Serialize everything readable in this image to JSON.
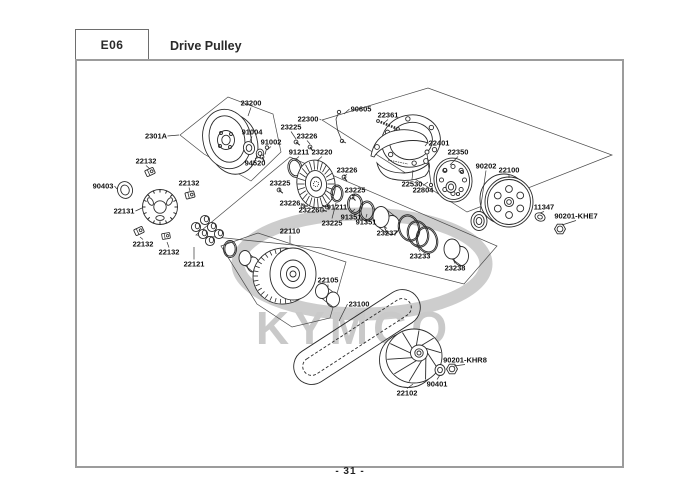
{
  "header": {
    "code": "E06",
    "title": "Drive Pulley"
  },
  "footer": {
    "page_number": "- 31 -"
  },
  "watermark": {
    "brand": "KYMCO"
  },
  "colors": {
    "line": "#2b2b2b",
    "frame_border": "#9c9c9c",
    "watermark_gray": "#cdcdcd"
  },
  "diagram": {
    "labels": [
      {
        "text": "23200",
        "x": 251,
        "y": 103,
        "tx": 248,
        "ty": 116
      },
      {
        "text": "2301A",
        "x": 156,
        "y": 136,
        "tx": 179,
        "ty": 135
      },
      {
        "text": "91004",
        "x": 252,
        "y": 132,
        "tx": 250,
        "ty": 141
      },
      {
        "text": "91002",
        "x": 271,
        "y": 142,
        "tx": 267,
        "ty": 150
      },
      {
        "text": "94520",
        "x": 255,
        "y": 163,
        "tx": 261,
        "ty": 157
      },
      {
        "text": "22132",
        "x": 146,
        "y": 161,
        "tx": 150,
        "ty": 169
      },
      {
        "text": "90403",
        "x": 103,
        "y": 186,
        "tx": 117,
        "ty": 189
      },
      {
        "text": "22131",
        "x": 124,
        "y": 211,
        "tx": 142,
        "ty": 208
      },
      {
        "text": "22132",
        "x": 189,
        "y": 183,
        "tx": 190,
        "ty": 191
      },
      {
        "text": "22132",
        "x": 143,
        "y": 244,
        "tx": 140,
        "ty": 237
      },
      {
        "text": "22132",
        "x": 169,
        "y": 252,
        "tx": 167,
        "ty": 242
      },
      {
        "text": "22121",
        "x": 194,
        "y": 264,
        "tx": 194,
        "ty": 247
      },
      {
        "text": "22300",
        "x": 308,
        "y": 119,
        "tx": 321,
        "ty": 120
      },
      {
        "text": "90605",
        "x": 361,
        "y": 109,
        "tx": 344,
        "ty": 114
      },
      {
        "text": "22361",
        "x": 388,
        "y": 115,
        "tx": 384,
        "ty": 123
      },
      {
        "text": "23225",
        "x": 291,
        "y": 127,
        "tx": 296,
        "ty": 139
      },
      {
        "text": "23226",
        "x": 307,
        "y": 136,
        "tx": 310,
        "ty": 144
      },
      {
        "text": "91211",
        "x": 299,
        "y": 152,
        "tx": 296,
        "ty": 159
      },
      {
        "text": "23220",
        "x": 322,
        "y": 152,
        "tx": 317,
        "ty": 161
      },
      {
        "text": "23226",
        "x": 347,
        "y": 170,
        "tx": 344,
        "ty": 176
      },
      {
        "text": "23225",
        "x": 355,
        "y": 190,
        "tx": 352,
        "ty": 196
      },
      {
        "text": "23225",
        "x": 280,
        "y": 183,
        "tx": 279,
        "ty": 190
      },
      {
        "text": "23226",
        "x": 290,
        "y": 203,
        "tx": 303,
        "ty": 206
      },
      {
        "text": "23226",
        "x": 309,
        "y": 210,
        "tx": 323,
        "ty": 210
      },
      {
        "text": "91211",
        "x": 337,
        "y": 207,
        "tx": 326,
        "ty": 207
      },
      {
        "text": "23225",
        "x": 332,
        "y": 223,
        "tx": 336,
        "ty": 203
      },
      {
        "text": "91351",
        "x": 351,
        "y": 217,
        "tx": 355,
        "ty": 209
      },
      {
        "text": "91351",
        "x": 366,
        "y": 222,
        "tx": 367,
        "ty": 214
      },
      {
        "text": "23237",
        "x": 387,
        "y": 233,
        "tx": 384,
        "ty": 226
      },
      {
        "text": "23233",
        "x": 420,
        "y": 256,
        "tx": 416,
        "ty": 244
      },
      {
        "text": "23238",
        "x": 455,
        "y": 268,
        "tx": 453,
        "ty": 259
      },
      {
        "text": "22401",
        "x": 439,
        "y": 143,
        "tx": 425,
        "ty": 146
      },
      {
        "text": "22350",
        "x": 458,
        "y": 152,
        "tx": 450,
        "ty": 165
      },
      {
        "text": "22530",
        "x": 412,
        "y": 184,
        "tx": 413,
        "ty": 170
      },
      {
        "text": "22804",
        "x": 423,
        "y": 190,
        "tx": 428,
        "ty": 182
      },
      {
        "text": "90202",
        "x": 486,
        "y": 166,
        "tx": 480,
        "ty": 212
      },
      {
        "text": "22100",
        "x": 509,
        "y": 170,
        "tx": 509,
        "ty": 178
      },
      {
        "text": "11347",
        "x": 544,
        "y": 207,
        "tx": 540,
        "ty": 213
      },
      {
        "text": "90201-KHE7",
        "x": 576,
        "y": 216,
        "tx": 562,
        "ty": 225
      },
      {
        "text": "22110",
        "x": 290,
        "y": 231,
        "tx": 290,
        "ty": 243
      },
      {
        "text": "22105",
        "x": 328,
        "y": 280,
        "tx": 328,
        "ty": 288
      },
      {
        "text": "23100",
        "x": 359,
        "y": 304,
        "tx": 339,
        "ty": 321
      },
      {
        "text": "22102",
        "x": 407,
        "y": 393,
        "tx": 413,
        "ty": 384
      },
      {
        "text": "90401",
        "x": 437,
        "y": 384,
        "tx": 440,
        "ty": 375
      },
      {
        "text": "90201-KHR8",
        "x": 465,
        "y": 360,
        "tx": 454,
        "ty": 366
      }
    ]
  }
}
